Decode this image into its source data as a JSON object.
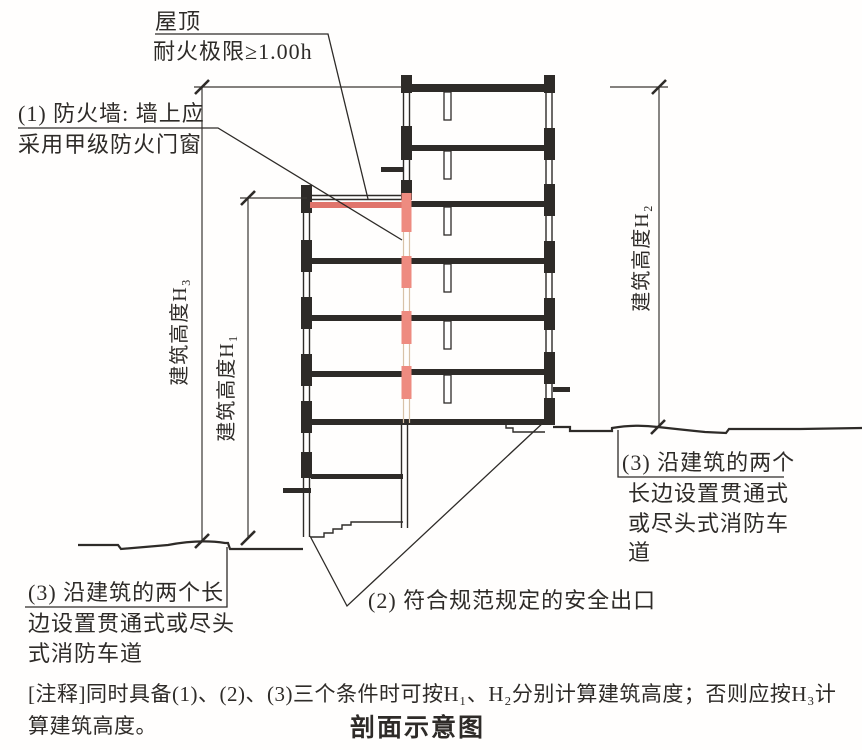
{
  "caption": "剖面示意图",
  "roof_note": {
    "line1": "屋顶",
    "line2": "耐火极限≥1.00h"
  },
  "firewall_note": {
    "line1": "(1) 防火墙: 墙上应",
    "line2": "采用甲级防火门窗"
  },
  "dimensions": {
    "h3_label": "建筑高度H₃",
    "h1_label": "建筑高度H₁",
    "h2_label": "建筑高度H₂"
  },
  "fire_lane_left": {
    "line1": "(3) 沿建筑的两个长",
    "line2": "边设置贯通式或尽头",
    "line3": "式消防车道"
  },
  "fire_lane_right": {
    "line1": "(3) 沿建筑的两个",
    "line2": "长边设置贯通式",
    "line3": "或尽头式消防车",
    "line4": "道"
  },
  "safety_exit_note": "(2) 符合规范规定的安全出口",
  "footnote": {
    "line1": "[注释]同时具备(1)、(2)、(3)三个条件时可按H₁、H₂分别计算建筑高度；否则应按H₃计",
    "line2": "算建筑高度。"
  },
  "colors": {
    "line": "#2e2b28",
    "firewall_red": "#ee8b80",
    "roof_red": "#e0756c",
    "background": "#ffffff"
  }
}
